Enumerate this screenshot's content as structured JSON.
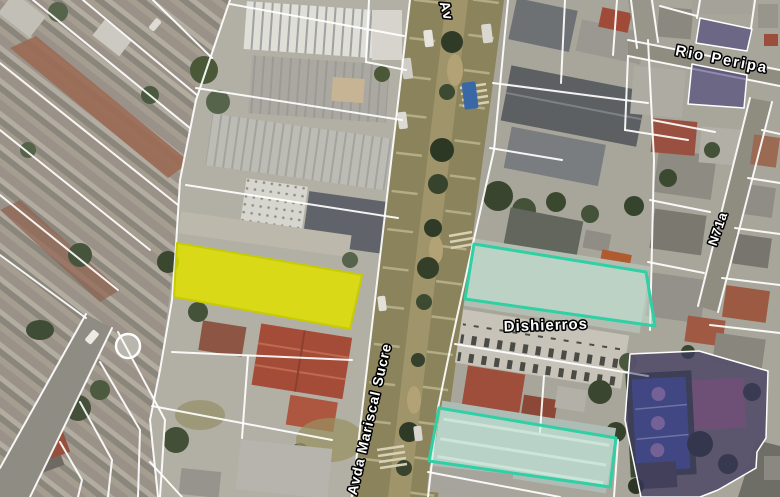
{
  "map": {
    "view_type": "satellite-cadastral",
    "colors": {
      "selection_yellow": "#e0e000",
      "selection_yellow_border": "#c6cc02",
      "highlight_teal_border": "#2ed0a4",
      "highlight_teal_fill": "#c3e8d8",
      "zoning_purple": "#3c3577",
      "boundary_white": "#ffffff",
      "label_text": "#ffffff",
      "road_surface": "#8b835c"
    },
    "street_labels": [
      {
        "name": "street-label-av-partial",
        "text": "Av",
        "x": 442,
        "y": 12,
        "rotation": 75,
        "size": 14,
        "spacing": 1
      },
      {
        "name": "street-label-avda-mariscal-sucre",
        "text": "Avda Mariscal Sucre",
        "x": 374,
        "y": 420,
        "rotation": -77,
        "size": 14,
        "spacing": 1
      },
      {
        "name": "street-label-rio-peripa",
        "text": "Rio Peripa",
        "x": 721,
        "y": 64,
        "rotation": 11,
        "size": 15,
        "spacing": 2
      },
      {
        "name": "street-label-n71a",
        "text": "N71a",
        "x": 722,
        "y": 230,
        "rotation": -71,
        "size": 13,
        "spacing": 1
      },
      {
        "name": "place-label-dishierros",
        "text": "Dishierros",
        "x": 546,
        "y": 330,
        "rotation": -2,
        "size": 15,
        "spacing": 1
      }
    ],
    "highlighted_parcels": [
      {
        "name": "selected-parcel-yellow",
        "points": "177,243 362,275 350,329 174,297",
        "fill": "#e0e000",
        "fill_opacity": 0.85,
        "stroke": "#c6cc02",
        "stroke_width": 2
      },
      {
        "name": "highlight-parcel-teal-north",
        "points": "474,244 646,272 655,326 465,299",
        "fill": "#c3e8d8",
        "fill_opacity": 0.5,
        "stroke": "#2ed0a4",
        "stroke_width": 3
      },
      {
        "name": "highlight-parcel-teal-south",
        "points": "439,408 616,438 610,487 429,461",
        "fill": "#c3e8d8",
        "fill_opacity": 0.5,
        "stroke": "#2ed0a4",
        "stroke_width": 3
      },
      {
        "name": "zoning-parcel-purple-north",
        "points": "700,18 752,29 747,51 696,43",
        "fill": "#3c3577",
        "fill_opacity": 0.55,
        "stroke": "#ffffff",
        "stroke_width": 1.5
      },
      {
        "name": "zoning-parcel-purple-mid",
        "points": "692,64 747,75 744,108 688,104",
        "fill": "#3c3577",
        "fill_opacity": 0.55,
        "stroke": "#ffffff",
        "stroke_width": 1.5
      },
      {
        "name": "zoning-parcel-purple-sportsfield",
        "points": "630,354 699,351 768,371 766,438 757,452 756,468 718,490 700,497 641,497 625,420",
        "fill": "#3c3577",
        "fill_opacity": 0.5,
        "stroke": "#ffffff",
        "stroke_width": 1.5
      }
    ],
    "boundary_lines": [
      {
        "points": "410,0 352,497"
      },
      {
        "points": "508,0 494,150 472,248 452,340 438,408 428,497"
      },
      {
        "points": "230,0 196,100 180,180 176,245 172,300 160,370 150,420 158,497"
      },
      {
        "points": "33,0 190,128"
      },
      {
        "points": "83,0 197,95"
      },
      {
        "points": "153,0 212,58"
      },
      {
        "points": "0,63 178,205"
      },
      {
        "points": "0,130 150,250"
      },
      {
        "points": "0,195 118,290"
      },
      {
        "points": "0,255 86,318"
      },
      {
        "points": "86,314 0,468"
      },
      {
        "points": "112,328 30,497"
      },
      {
        "points": "118,332 165,420 160,497"
      },
      {
        "points": "100,362 140,430 138,497"
      },
      {
        "points": "80,402 112,460 108,497"
      },
      {
        "points": "60,442 82,480 78,497"
      },
      {
        "points": "196,88 402,120"
      },
      {
        "points": "186,185 398,218"
      },
      {
        "points": "172,352 352,360"
      },
      {
        "points": "152,406 332,440"
      },
      {
        "points": "150,462 182,497"
      },
      {
        "points": "248,356 242,438"
      },
      {
        "points": "230,4 404,36"
      },
      {
        "points": "369,0 366,62"
      },
      {
        "points": "366,62 406,70"
      },
      {
        "points": "493,83 648,103"
      },
      {
        "points": "565,0 561,83"
      },
      {
        "points": "617,0 613,55"
      },
      {
        "points": "490,148 562,160"
      },
      {
        "points": "648,40 654,160 650,330"
      },
      {
        "points": "455,344 648,376"
      },
      {
        "points": "544,376 540,432"
      },
      {
        "points": "428,472 560,497"
      },
      {
        "points": "652,120 715,132"
      },
      {
        "points": "650,200 710,212"
      },
      {
        "points": "648,262 704,273"
      },
      {
        "points": "762,130 780,134"
      },
      {
        "points": "748,178 780,183"
      },
      {
        "points": "735,228 780,234"
      },
      {
        "points": "722,278 780,285"
      },
      {
        "points": "710,325 780,333"
      },
      {
        "points": "700,0 697,18"
      },
      {
        "points": "660,6 697,16"
      },
      {
        "points": "755,0 751,28"
      },
      {
        "points": "628,56 625,130"
      },
      {
        "points": "625,130 688,140"
      },
      {
        "points": "618,440 614,497"
      },
      {
        "points": "631,0 637,48"
      },
      {
        "points": "652,0 658,42"
      },
      {
        "points": "628,40 780,70"
      },
      {
        "points": "628,56 780,86"
      },
      {
        "points": "750,98 698,306"
      },
      {
        "points": "772,102 718,312"
      }
    ]
  }
}
